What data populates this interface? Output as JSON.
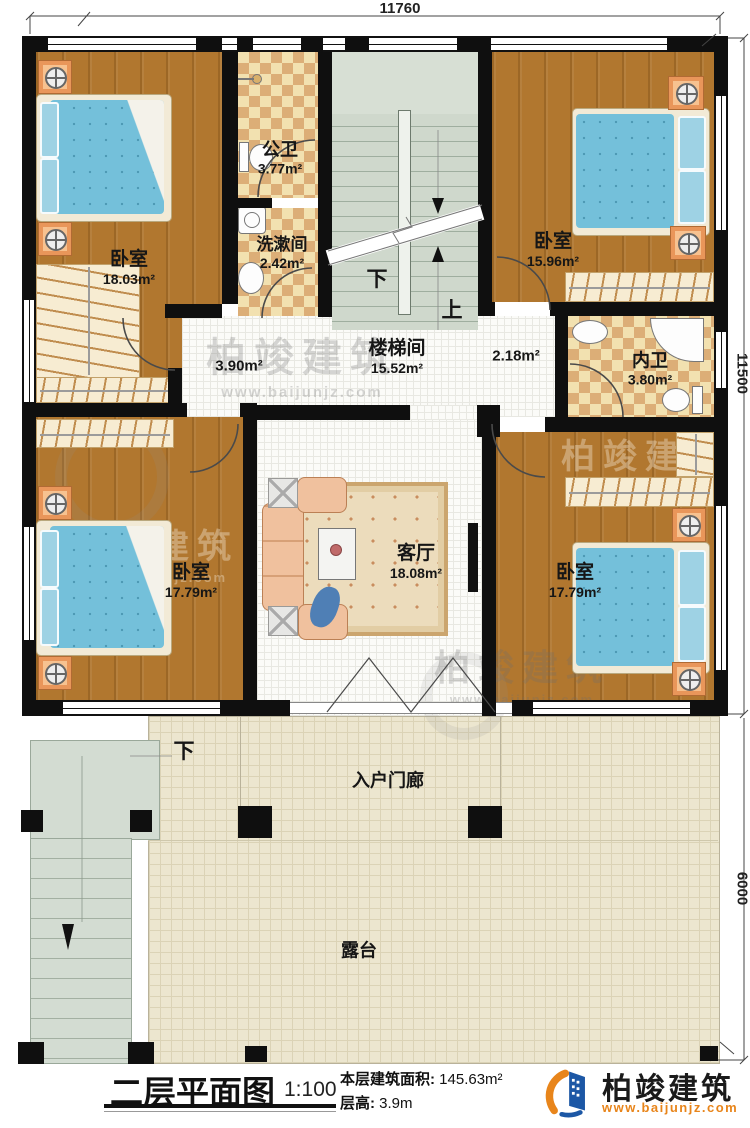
{
  "dims": {
    "top": "11760",
    "right_upper": "11500",
    "right_lower": "6000"
  },
  "rooms": {
    "bedroom_tl": {
      "name": "卧室",
      "area": "18.03m²"
    },
    "public_bath": {
      "name": "公卫",
      "area": "3.77m²"
    },
    "washroom": {
      "name": "洗漱间",
      "area": "2.42m²"
    },
    "stair_hall": {
      "name": "楼梯间",
      "area": "15.52m²"
    },
    "hall_left": {
      "area": "3.90m²"
    },
    "hall_right": {
      "area": "2.18m²"
    },
    "bedroom_tr": {
      "name": "卧室",
      "area": "15.96m²"
    },
    "inner_bath": {
      "name": "内卫",
      "area": "3.80m²"
    },
    "bedroom_bl": {
      "name": "卧室",
      "area": "17.79m²"
    },
    "living_room": {
      "name": "客厅",
      "area": "18.08m²"
    },
    "bedroom_br": {
      "name": "卧室",
      "area": "17.79m²"
    },
    "porch": {
      "name": "入户门廊"
    },
    "terrace": {
      "name": "露台"
    }
  },
  "stairs": {
    "down": "下",
    "up": "上",
    "porch_down": "下"
  },
  "title_block": {
    "title": "二层平面图",
    "scale": "1:100",
    "floor_area_label": "本层建筑面积:",
    "floor_area_value": "145.63m²",
    "floor_height_label": "层高:",
    "floor_height_value": "3.9m"
  },
  "brand": {
    "name": "柏竣建筑",
    "website": "www.baijunjz.com"
  }
}
